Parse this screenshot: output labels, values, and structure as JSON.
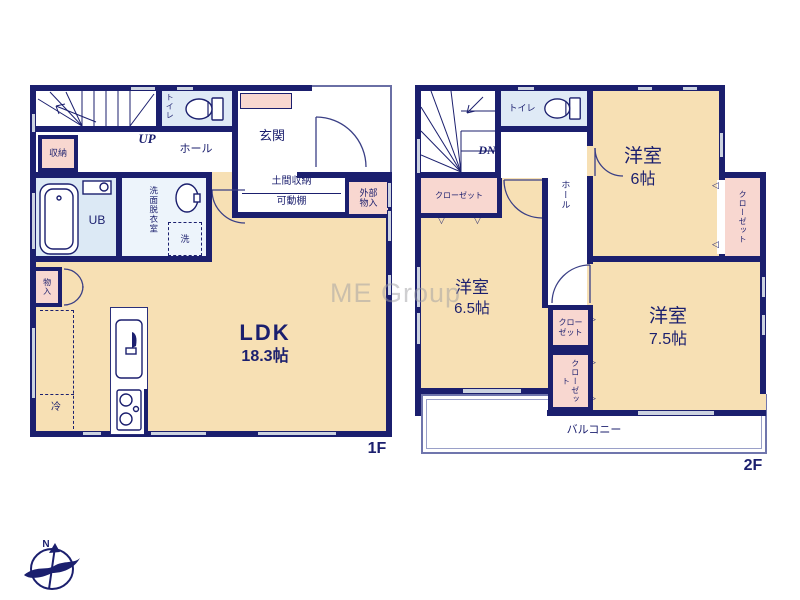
{
  "palette": {
    "wall_navy": "#1b1f6e",
    "room_cream": "#f7e0b4",
    "closet_pink": "#f8d7d0",
    "wet_blue": "#dfeaf6",
    "window_gray": "#ccd3e0"
  },
  "watermark": {
    "text": "ME Group"
  },
  "compass": {
    "north": "N"
  },
  "symbols": {
    "tri_down": "▽",
    "tri_left": "◁",
    "tri_right": "▷"
  },
  "floor1": {
    "floor_label": "1F",
    "rooms": {
      "stairs_up": "UP",
      "toilet": "トイレ",
      "storage": "収納",
      "hall": "ホール",
      "entrance": "玄関",
      "unit_bath": "UB",
      "washroom": "洗面脱衣室",
      "washer": "洗",
      "doma_storage": "土間収納",
      "movable_shelf": "可動棚",
      "exterior_storage_line1": "外部",
      "exterior_storage_line2": "物入",
      "small_storage": "物入",
      "fridge": "冷",
      "ldk_name": "LDK",
      "ldk_size": "18.3帖"
    }
  },
  "floor2": {
    "floor_label": "2F",
    "rooms": {
      "stairs_down": "DN",
      "toilet": "トイレ",
      "hall": "ホール",
      "closet_a": "クローゼット",
      "closet_b": "クローゼット",
      "closet_c_line1": "クロー",
      "closet_c_line2": "ゼット",
      "closet_d": "クローゼット",
      "room6_name": "洋室",
      "room6_size": "6帖",
      "room65_name": "洋室",
      "room65_size": "6.5帖",
      "room75_name": "洋室",
      "room75_size": "7.5帖",
      "balcony": "バルコニー"
    }
  }
}
